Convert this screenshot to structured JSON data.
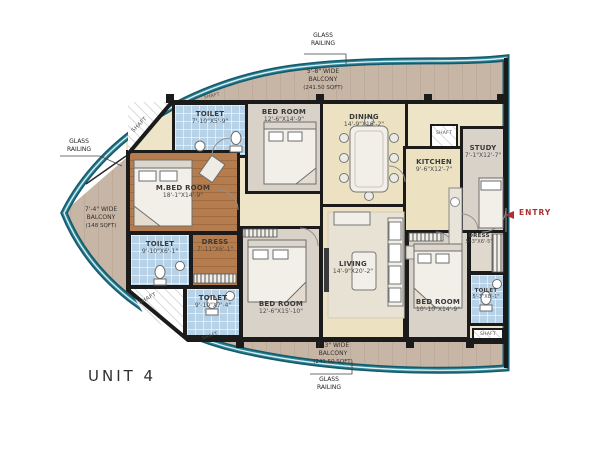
{
  "unit_title": "UNIT 4",
  "labels": {
    "shaft": "SHAFT",
    "entry": "ENTRY",
    "glass_railing_line1": "GLASS",
    "glass_railing_line2": "RAILING"
  },
  "balconies": {
    "top": {
      "width": "5'-8\" WIDE",
      "name": "BALCONY",
      "area": "(241.50 SQFT)"
    },
    "left": {
      "width": "7'-4\" WIDE",
      "name": "BALCONY",
      "area": "(148 SQFT)"
    },
    "bottom": {
      "width": "7'-3\" WIDE",
      "name": "BALCONY",
      "area": "(241.50 SQFT)"
    }
  },
  "rooms": {
    "toilet_top": {
      "name": "TOILET",
      "dims": "7'-10\"X5'-9\""
    },
    "bedroom_top": {
      "name": "BED ROOM",
      "dims": "12'-6\"X14'-9\""
    },
    "dining": {
      "name": "DINING",
      "dims": "14'-9\"X16'-2\""
    },
    "kitchen": {
      "name": "KITCHEN",
      "dims": "9'-6\"X12'-7\""
    },
    "study": {
      "name": "STUDY",
      "dims": "7'-1\"X12'-7\""
    },
    "master_bedroom": {
      "name": "M.BED ROOM",
      "dims": "18'-1\"X14'-9\""
    },
    "toilet_mid": {
      "name": "TOILET",
      "dims": "9'-10\"X6'-1\""
    },
    "dress_mid": {
      "name": "DRESS",
      "dims": "7'-11\"X6'-1\""
    },
    "toilet_bottom_left": {
      "name": "TOILET",
      "dims": "9'-10\"X7'-4\""
    },
    "bedroom_bottom": {
      "name": "BED ROOM",
      "dims": "12'-6\"X15'-10\""
    },
    "living": {
      "name": "LIVING",
      "dims": "14'-9\"X20'-2\""
    },
    "bedroom_right": {
      "name": "BED ROOM",
      "dims": "10'-10\"X14'-9\""
    },
    "dress_right": {
      "name": "DRESS",
      "dims": "5'-3\"X6'-5\""
    },
    "toilet_right": {
      "name": "TOILET",
      "dims": "5'-3\"X8'-1\""
    }
  },
  "colors": {
    "wall": "#1b1b1b",
    "wood_floor": "#b57c4e",
    "tile_blue": "#b7d2e6",
    "hall_cream": "#ece2c2",
    "bedroom_gray": "#d8d2c9",
    "balcony_tan": "#c7b6a5",
    "railing_teal": "#2a7f91",
    "entry_red": "#b03030"
  }
}
